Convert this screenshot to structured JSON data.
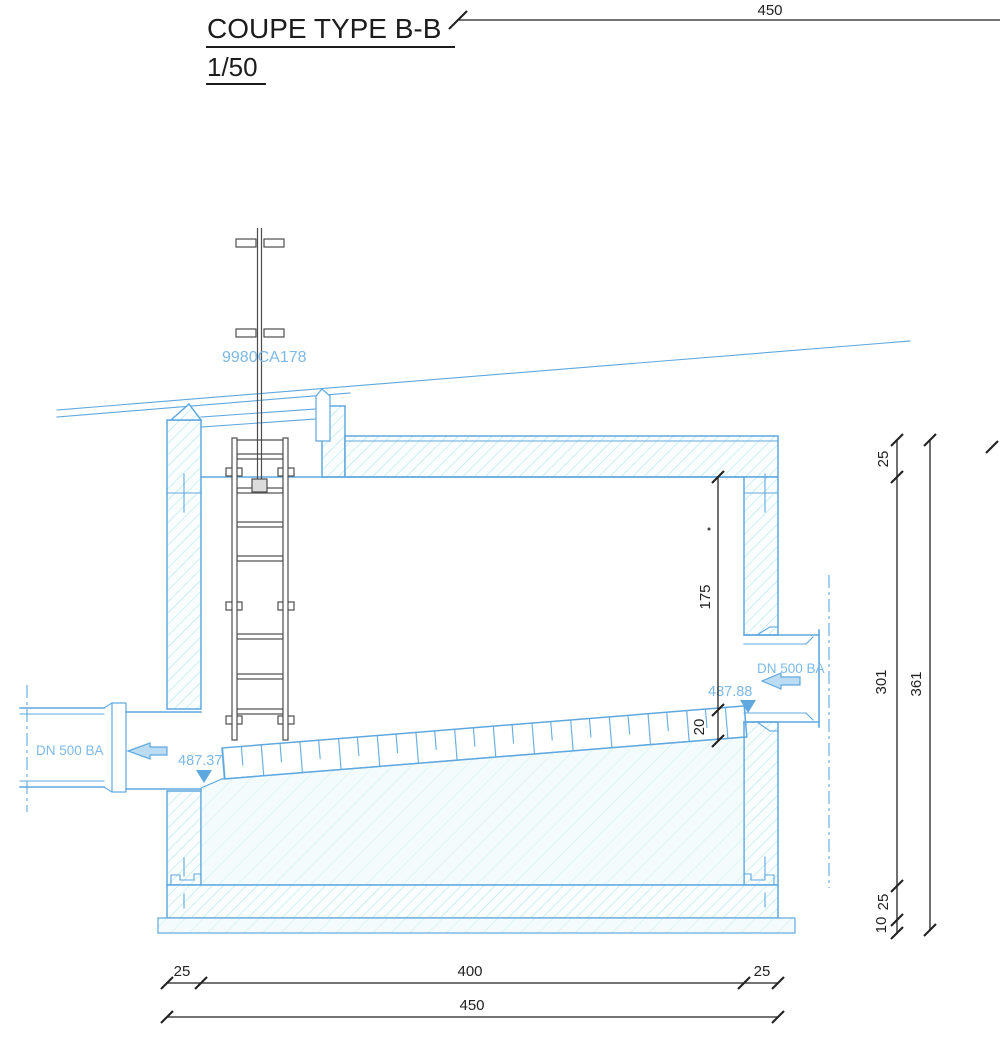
{
  "title": {
    "name": "COUPE TYPE B-B",
    "scale": "1/50"
  },
  "tags": {
    "equipment": "9980CA178"
  },
  "pipes": {
    "left": {
      "label": "DN 500 BA",
      "invert": "487.37"
    },
    "right": {
      "label": "DN 500 BA",
      "invert": "487.88"
    }
  },
  "dimensions": {
    "top_total": "450",
    "slab": "25",
    "interior_height": "301",
    "floor": "25",
    "lean_concrete": "10",
    "total_height": "361",
    "ceiling_to_invert": "175",
    "channel_depth": "20",
    "wall_left": "25",
    "inner_width": "400",
    "wall_right": "25",
    "total_width": "450"
  },
  "colors": {
    "structure_blue": "#5fa8df",
    "label_blue": "#7db9e8",
    "hatch_teal": "#b2e5eb",
    "hatch_light": "#cfeff3",
    "dimension_black": "#222222",
    "ladder_gray": "#4d4d4d"
  }
}
